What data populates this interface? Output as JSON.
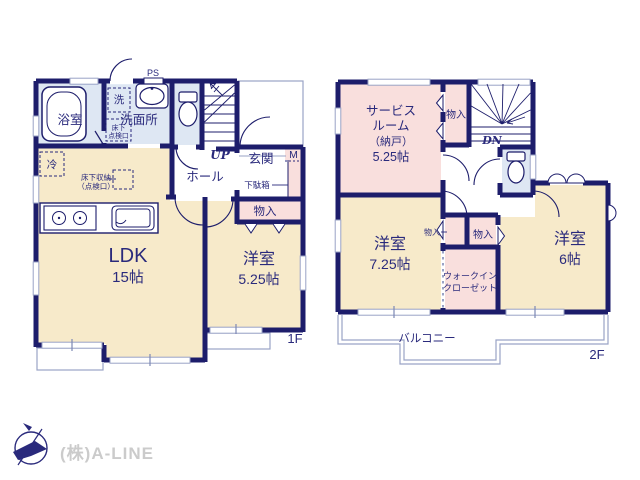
{
  "colors": {
    "wall_navy": "#1d1d6b",
    "text_navy": "#2a2a7c",
    "room_cream": "#f7eaca",
    "room_pink": "#f9dfdd",
    "room_blue": "#dee7f3",
    "window_gray_blue": "#9aa3c6",
    "watermark_gray": "#cbcbcb",
    "background": "#ffffff"
  },
  "floor1": {
    "floor_label": "1F",
    "ps": "PS",
    "bathroom": "浴室",
    "washer": "洗",
    "washroom": "洗面所",
    "hatch_line1": "床下",
    "hatch_line2": "点検口",
    "up": "UP",
    "hall": "ホール",
    "entrance": "玄関",
    "meter": "M",
    "shoe_box": "下駄箱",
    "closet": "物入",
    "fridge": "冷",
    "underfloor_line1": "床下収納",
    "underfloor_line2": "（点検口）",
    "ldk": "LDK",
    "ldk_size": "15帖",
    "western_room": "洋室",
    "western_room_size": "5.25帖"
  },
  "floor2": {
    "floor_label": "2F",
    "service_line1": "サービス",
    "service_line2": "ルーム",
    "service_line3": "（納戸）",
    "service_size": "5.25帖",
    "closet_top": "物入",
    "dn": "DN",
    "closet_small": "物入",
    "closet_mid": "物入",
    "wic_line1": "ウォークイン",
    "wic_line2": "クローゼット",
    "western_a": "洋室",
    "western_a_size": "7.25帖",
    "western_b": "洋室",
    "western_b_size": "6帖",
    "balcony": "バルコニー"
  },
  "footer": {
    "company": "(株)A-LINE"
  }
}
